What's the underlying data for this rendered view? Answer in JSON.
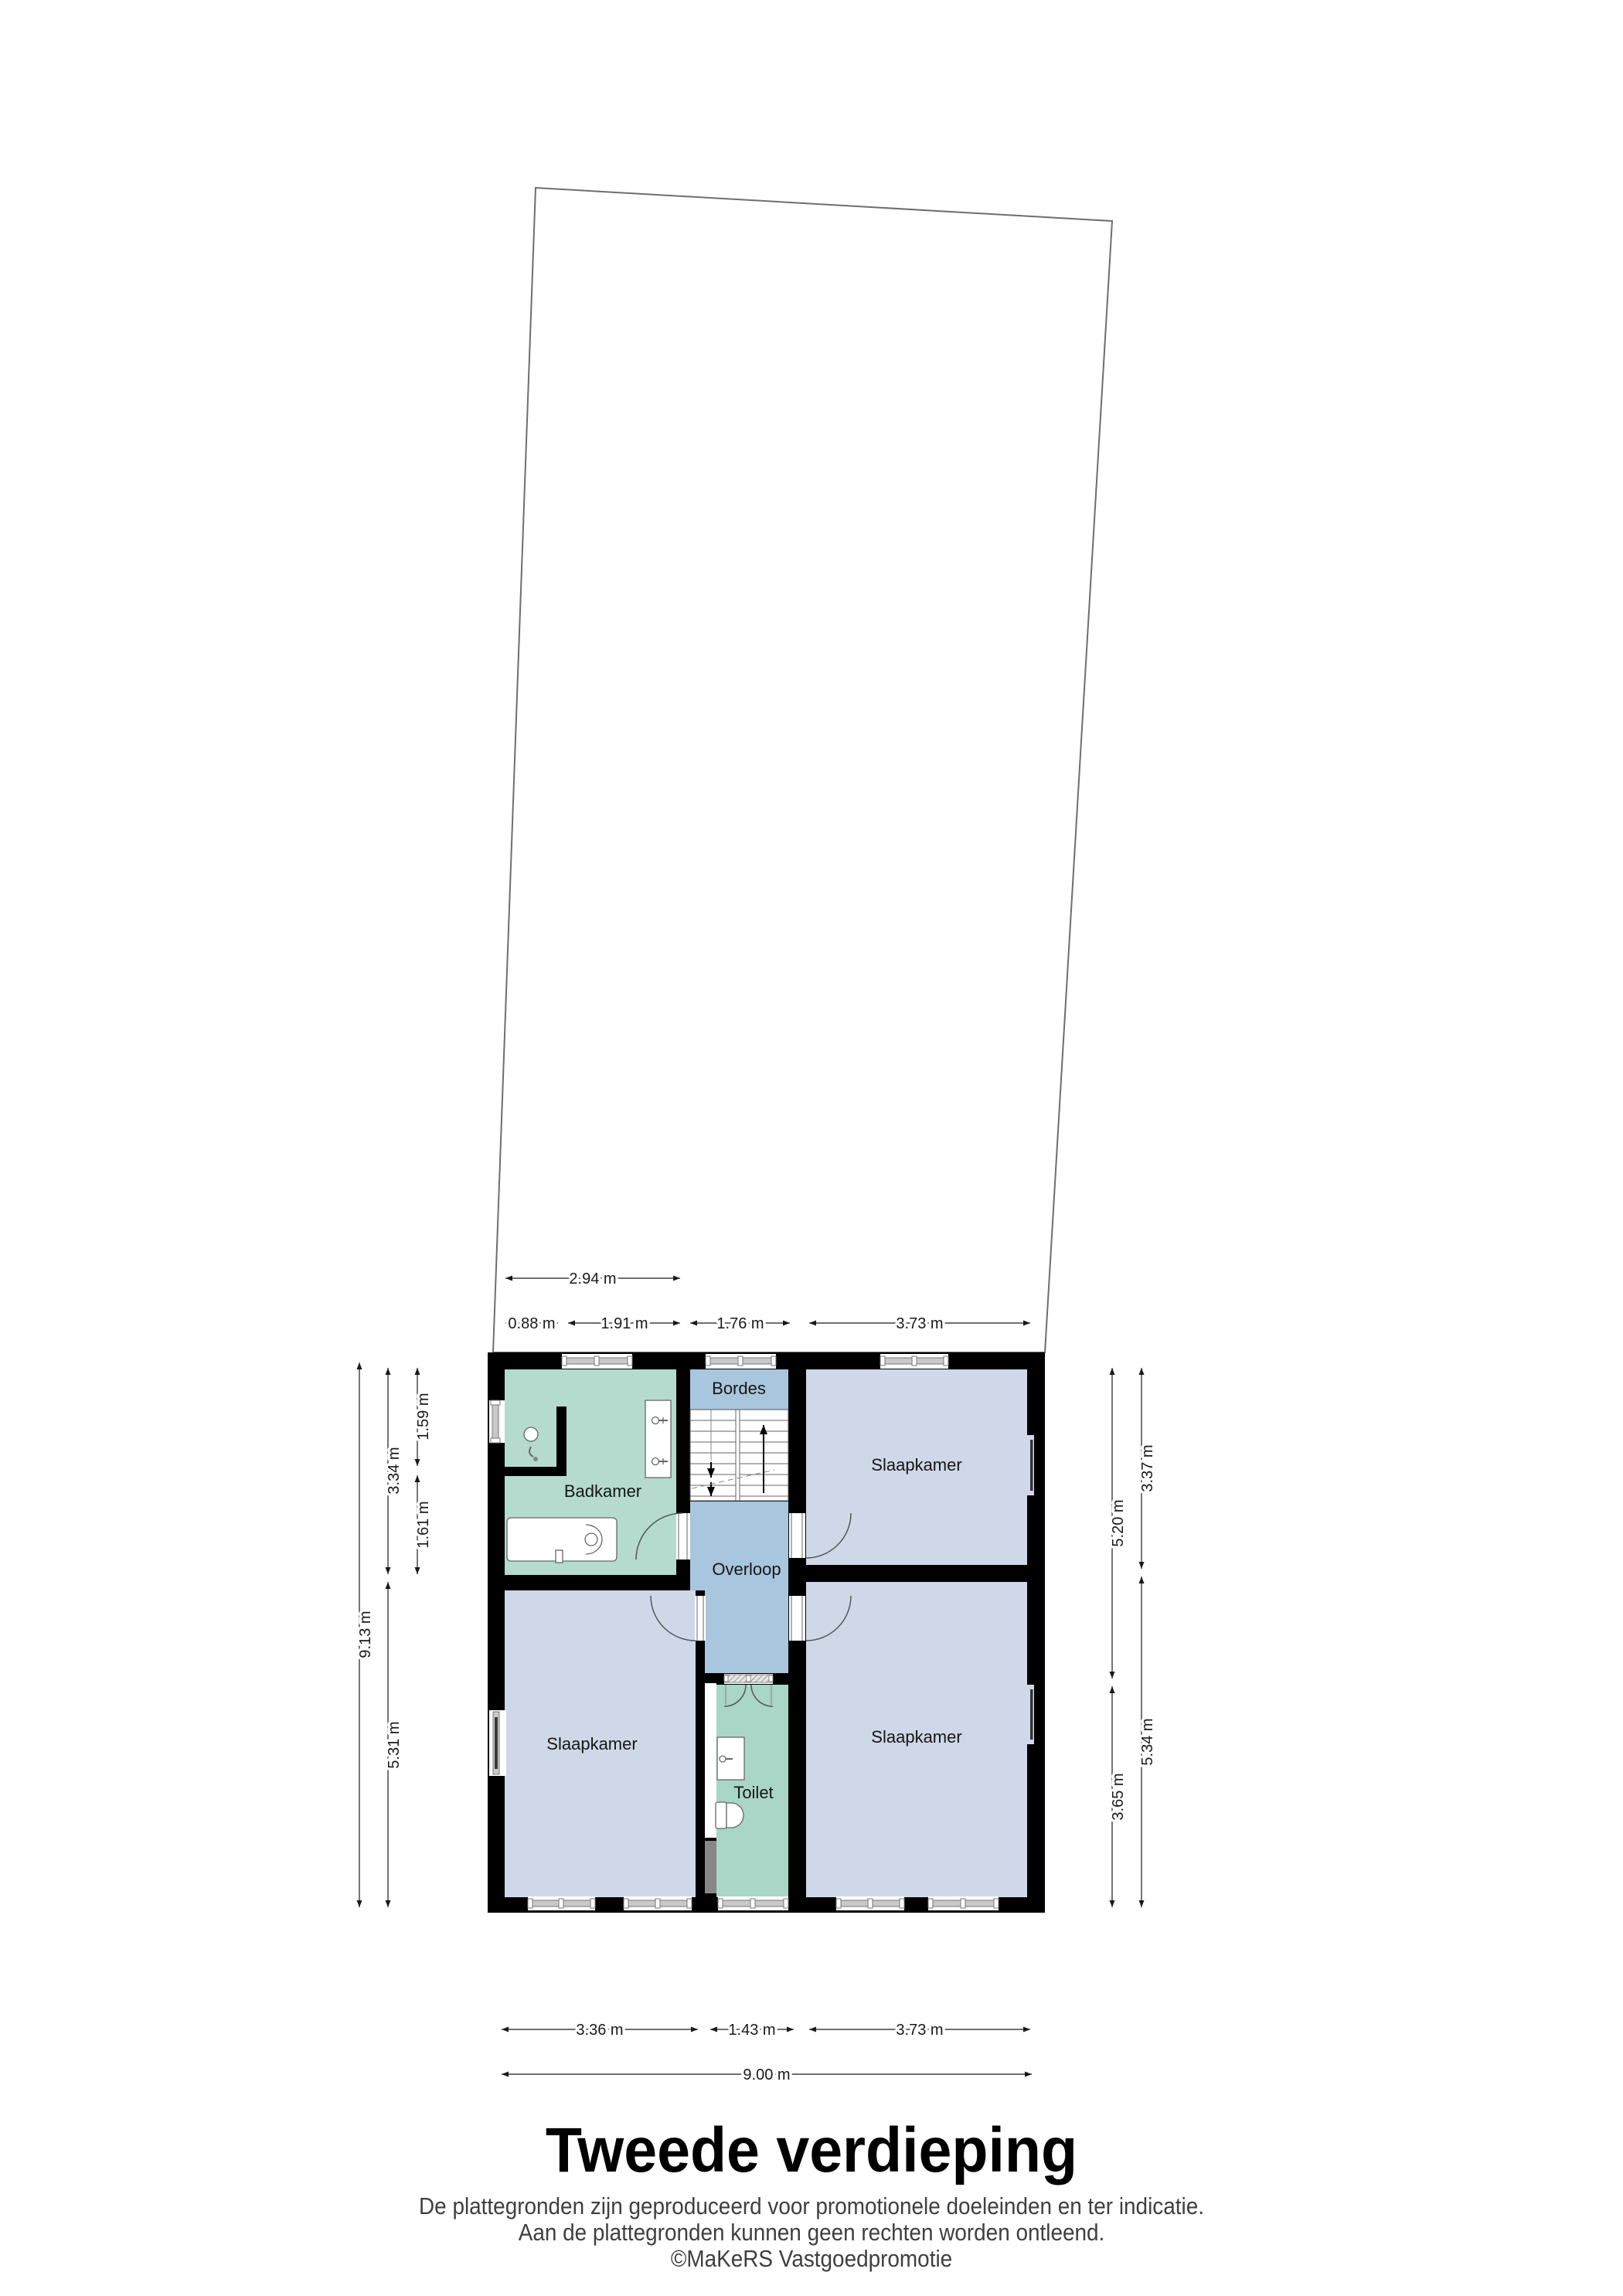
{
  "title": "Tweede verdieping",
  "footer": {
    "line1": "De plattegronden zijn geproduceerd voor promotionele doeleinden en ter indicatie.",
    "line2": "Aan de plattegronden kunnen geen rechten worden ontleend.",
    "line3": "©MaKeRS Vastgoedpromotie"
  },
  "rooms": {
    "badkamer": "Badkamer",
    "bordes": "Bordes",
    "overloop": "Overloop",
    "toilet": "Toilet",
    "slaapkamer_top_right": "Slaapkamer",
    "slaapkamer_bottom_left": "Slaapkamer",
    "slaapkamer_bottom_right": "Slaapkamer"
  },
  "dimensions": {
    "top": [
      "2.94 m",
      "0.88 m",
      "1.91 m",
      "1.76 m",
      "3.73 m"
    ],
    "bottom": [
      "3.36 m",
      "1.43 m",
      "3.73 m",
      "9.00 m"
    ],
    "left": [
      "9.13 m",
      "3.34 m",
      "5.31 m",
      "1.59 m",
      "1.61 m"
    ],
    "right": [
      "5.20 m",
      "3.65 m",
      "3.37 m",
      "5.34 m"
    ]
  },
  "colors": {
    "wall": "#000000",
    "bathroom_fill": "#b4dbce",
    "toilet_fill": "#a9d6c6",
    "bedroom_fill": "#ced8e8",
    "hall_fill": "#a8c6dd",
    "window_band": "#c9c9c9",
    "parcel_line": "#6e6e6e"
  }
}
